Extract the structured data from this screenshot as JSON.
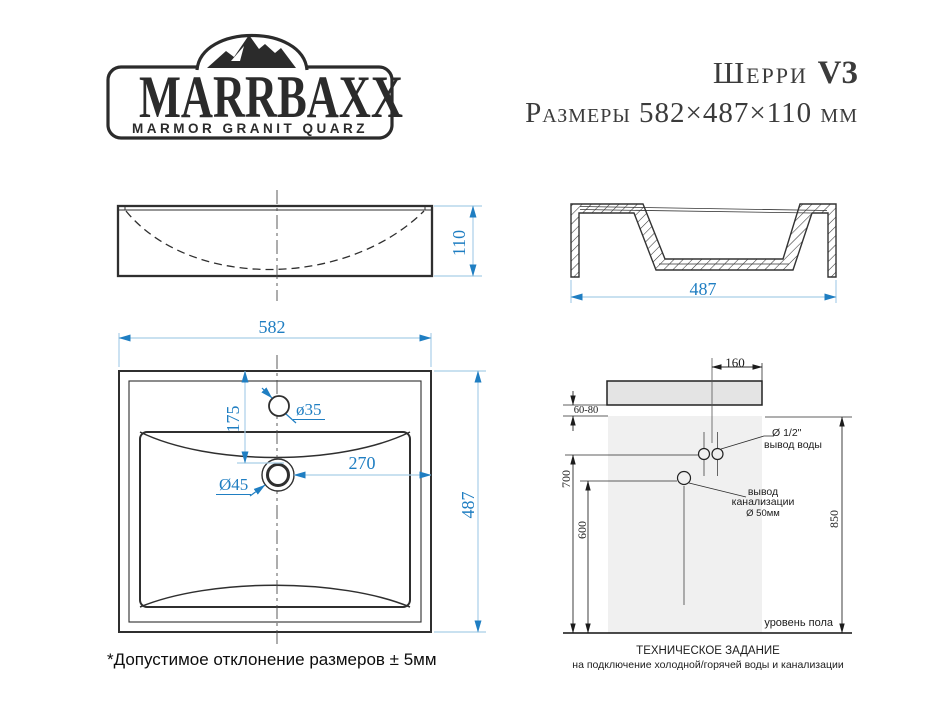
{
  "logo": {
    "brand": "MARRBAXX",
    "tagline": "MARMOR GRANIT QUARZ"
  },
  "header": {
    "model": "Шерри",
    "version": "V3",
    "size_line": "Размеры 582×487×110 мм"
  },
  "views": {
    "front": {
      "height": "110"
    },
    "side": {
      "depth": "487"
    },
    "top": {
      "width": "582",
      "depth": "487",
      "faucet_hole": "ø35",
      "faucet_offset": "175",
      "drain_hole": "Ø45",
      "drain_offset": "270"
    }
  },
  "installation": {
    "tap_offset": "160",
    "wall_gap": "60-80",
    "water_height": "700",
    "sewage_height": "600",
    "rim_height": "850",
    "water_outlet_size": "Ø 1/2\"",
    "water_outlet_label": "вывод воды",
    "sewage_label_1": "вывод",
    "sewage_label_2": "канализации",
    "sewage_size": "Ø 50мм",
    "floor_label": "уровень пола",
    "caption_1": "ТЕХНИЧЕСКОЕ ЗАДАНИЕ",
    "caption_2": "на подключение холодной/горячей воды и канализации"
  },
  "footnote": "*Допустимое отклонение размеров ± 5мм",
  "colors": {
    "dim_text": "#1f7ec2",
    "dim_line": "#a9cfe8",
    "line_dark": "#333333"
  }
}
